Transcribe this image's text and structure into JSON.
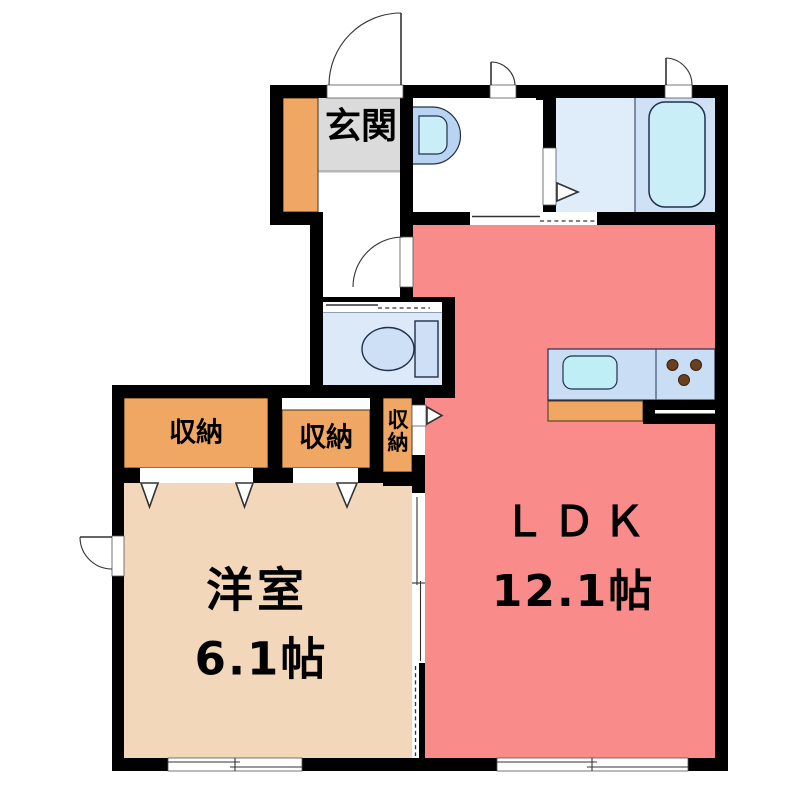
{
  "rooms": {
    "genkan": {
      "label": "玄関"
    },
    "ldk": {
      "label": "ＬＤＫ",
      "size": "12.1帖"
    },
    "western": {
      "label": "洋室",
      "size": "6.1帖"
    },
    "closet1": {
      "label": "収納"
    },
    "closet2": {
      "label": "収納"
    },
    "closet3": {
      "label": "収納"
    }
  },
  "fixtures": {
    "bathtub": "bathtub",
    "toilet": "toilet",
    "washbasin": "washbasin",
    "kitchen_sink": "kitchen-sink",
    "stove_burners": "stove-burners"
  },
  "colors": {
    "wall": "#000000",
    "ldk": "#f98b8b",
    "western": "#f2d7ba",
    "storage": "#f0a763",
    "genkan-floor": "#dbdbdb",
    "bath-floor": "#dfecfa",
    "bath-tub-zone": "#cfe2f5",
    "tub": "#c9eef8",
    "toilet-floor": "#dce9f9",
    "fixture": "#cde0f6",
    "counter": "#c9ddf4",
    "sink": "#bfeef7",
    "basin": "#b9d3f2",
    "basin-bowl": "#c9eef8",
    "burner": "#6b3f1d",
    "outline": "#22304a"
  }
}
